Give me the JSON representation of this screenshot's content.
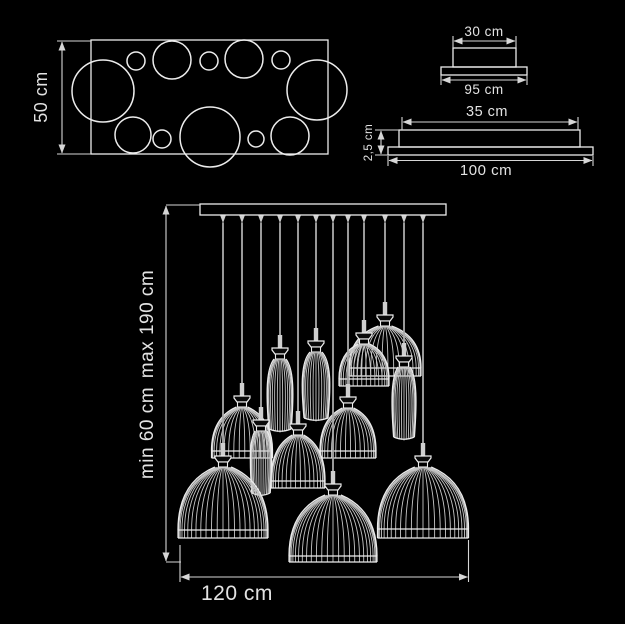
{
  "doc": {
    "title": "Pendant chandelier dimensional drawing"
  },
  "colors": {
    "background": "#000000",
    "line": "#ececec",
    "dim_line": "#d6d6d6",
    "text": "#e3e3e3",
    "rib": "#c6c6c6",
    "cord": "#ababab",
    "metal": "#cfcfcf"
  },
  "top_view": {
    "height_label": "50 cm",
    "rect": {
      "x": 91,
      "y": 40,
      "w": 237,
      "h": 114
    },
    "circles": [
      [
        103,
        91,
        31
      ],
      [
        136,
        61,
        9
      ],
      [
        172,
        60,
        19
      ],
      [
        209,
        61,
        9
      ],
      [
        244,
        59,
        19
      ],
      [
        281,
        60,
        9
      ],
      [
        317,
        90,
        30
      ],
      [
        133,
        135,
        18
      ],
      [
        162,
        139,
        9
      ],
      [
        210,
        137,
        30
      ],
      [
        256,
        139,
        8
      ],
      [
        290,
        136,
        19
      ]
    ]
  },
  "end_view": {
    "top_label": "30 cm",
    "bottom_label": "95 cm"
  },
  "front_view": {
    "top_label": "35 cm",
    "height_label": "2,5 cm",
    "bottom_label": "100 cm"
  },
  "elevation": {
    "min_label": "min 60 cm",
    "max_label": "max 190 cm",
    "width_label": "120 cm",
    "canopy": {
      "x": 200,
      "y": 204,
      "w": 246,
      "h": 11
    },
    "lamps": [
      {
        "x": 223,
        "drop": 459,
        "type": "dome",
        "w": 90,
        "h": 63,
        "rim": 8
      },
      {
        "x": 242,
        "drop": 399,
        "type": "dome",
        "w": 61,
        "h": 44,
        "rim": 7
      },
      {
        "x": 261,
        "drop": 423,
        "type": "tall",
        "w": 23,
        "h": 62,
        "rim": 0
      },
      {
        "x": 280,
        "drop": 351,
        "type": "tall",
        "w": 28,
        "h": 70,
        "rim": 0
      },
      {
        "x": 298,
        "drop": 427,
        "type": "dome",
        "w": 54,
        "h": 46,
        "rim": 7
      },
      {
        "x": 316,
        "drop": 344,
        "type": "tall",
        "w": 30,
        "h": 66,
        "rim": 0
      },
      {
        "x": 333,
        "drop": 487,
        "type": "dome",
        "w": 88,
        "h": 61,
        "rim": 6
      },
      {
        "x": 348,
        "drop": 400,
        "type": "dome",
        "w": 56,
        "h": 43,
        "rim": 7
      },
      {
        "x": 364,
        "drop": 336,
        "type": "dome",
        "w": 50,
        "h": 35,
        "rim": 7
      },
      {
        "x": 385,
        "drop": 318,
        "type": "dome",
        "w": 72,
        "h": 42,
        "rim": 8
      },
      {
        "x": 404,
        "drop": 359,
        "type": "tall",
        "w": 26,
        "h": 70,
        "rim": 0
      },
      {
        "x": 423,
        "drop": 459,
        "type": "dome",
        "w": 91,
        "h": 62,
        "rim": 9
      }
    ]
  }
}
